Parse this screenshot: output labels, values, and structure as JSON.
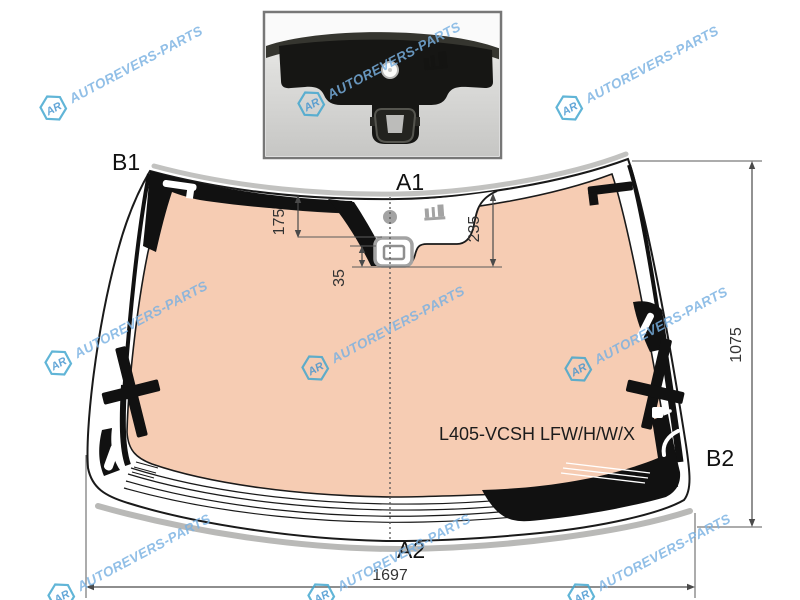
{
  "diagram": {
    "part_number": "L405-VCSH LFW/H/W/X",
    "labels": {
      "b1": "B1",
      "a1": "A1",
      "b2": "B2",
      "a2": "A2"
    },
    "dimensions": {
      "sensor_offset_top": "175",
      "cutout_depth": "235",
      "bracket_offset": "35",
      "height": "1075",
      "width": "1697"
    },
    "colors": {
      "glass_tint": "#f6ccb3",
      "frit_black": "#111111",
      "outline": "#1a1a1a",
      "dimension_text": "#333333"
    }
  },
  "watermark": {
    "text": "AUTOREVERS-PARTS",
    "logo": "AR",
    "color": "#79b1e2"
  }
}
